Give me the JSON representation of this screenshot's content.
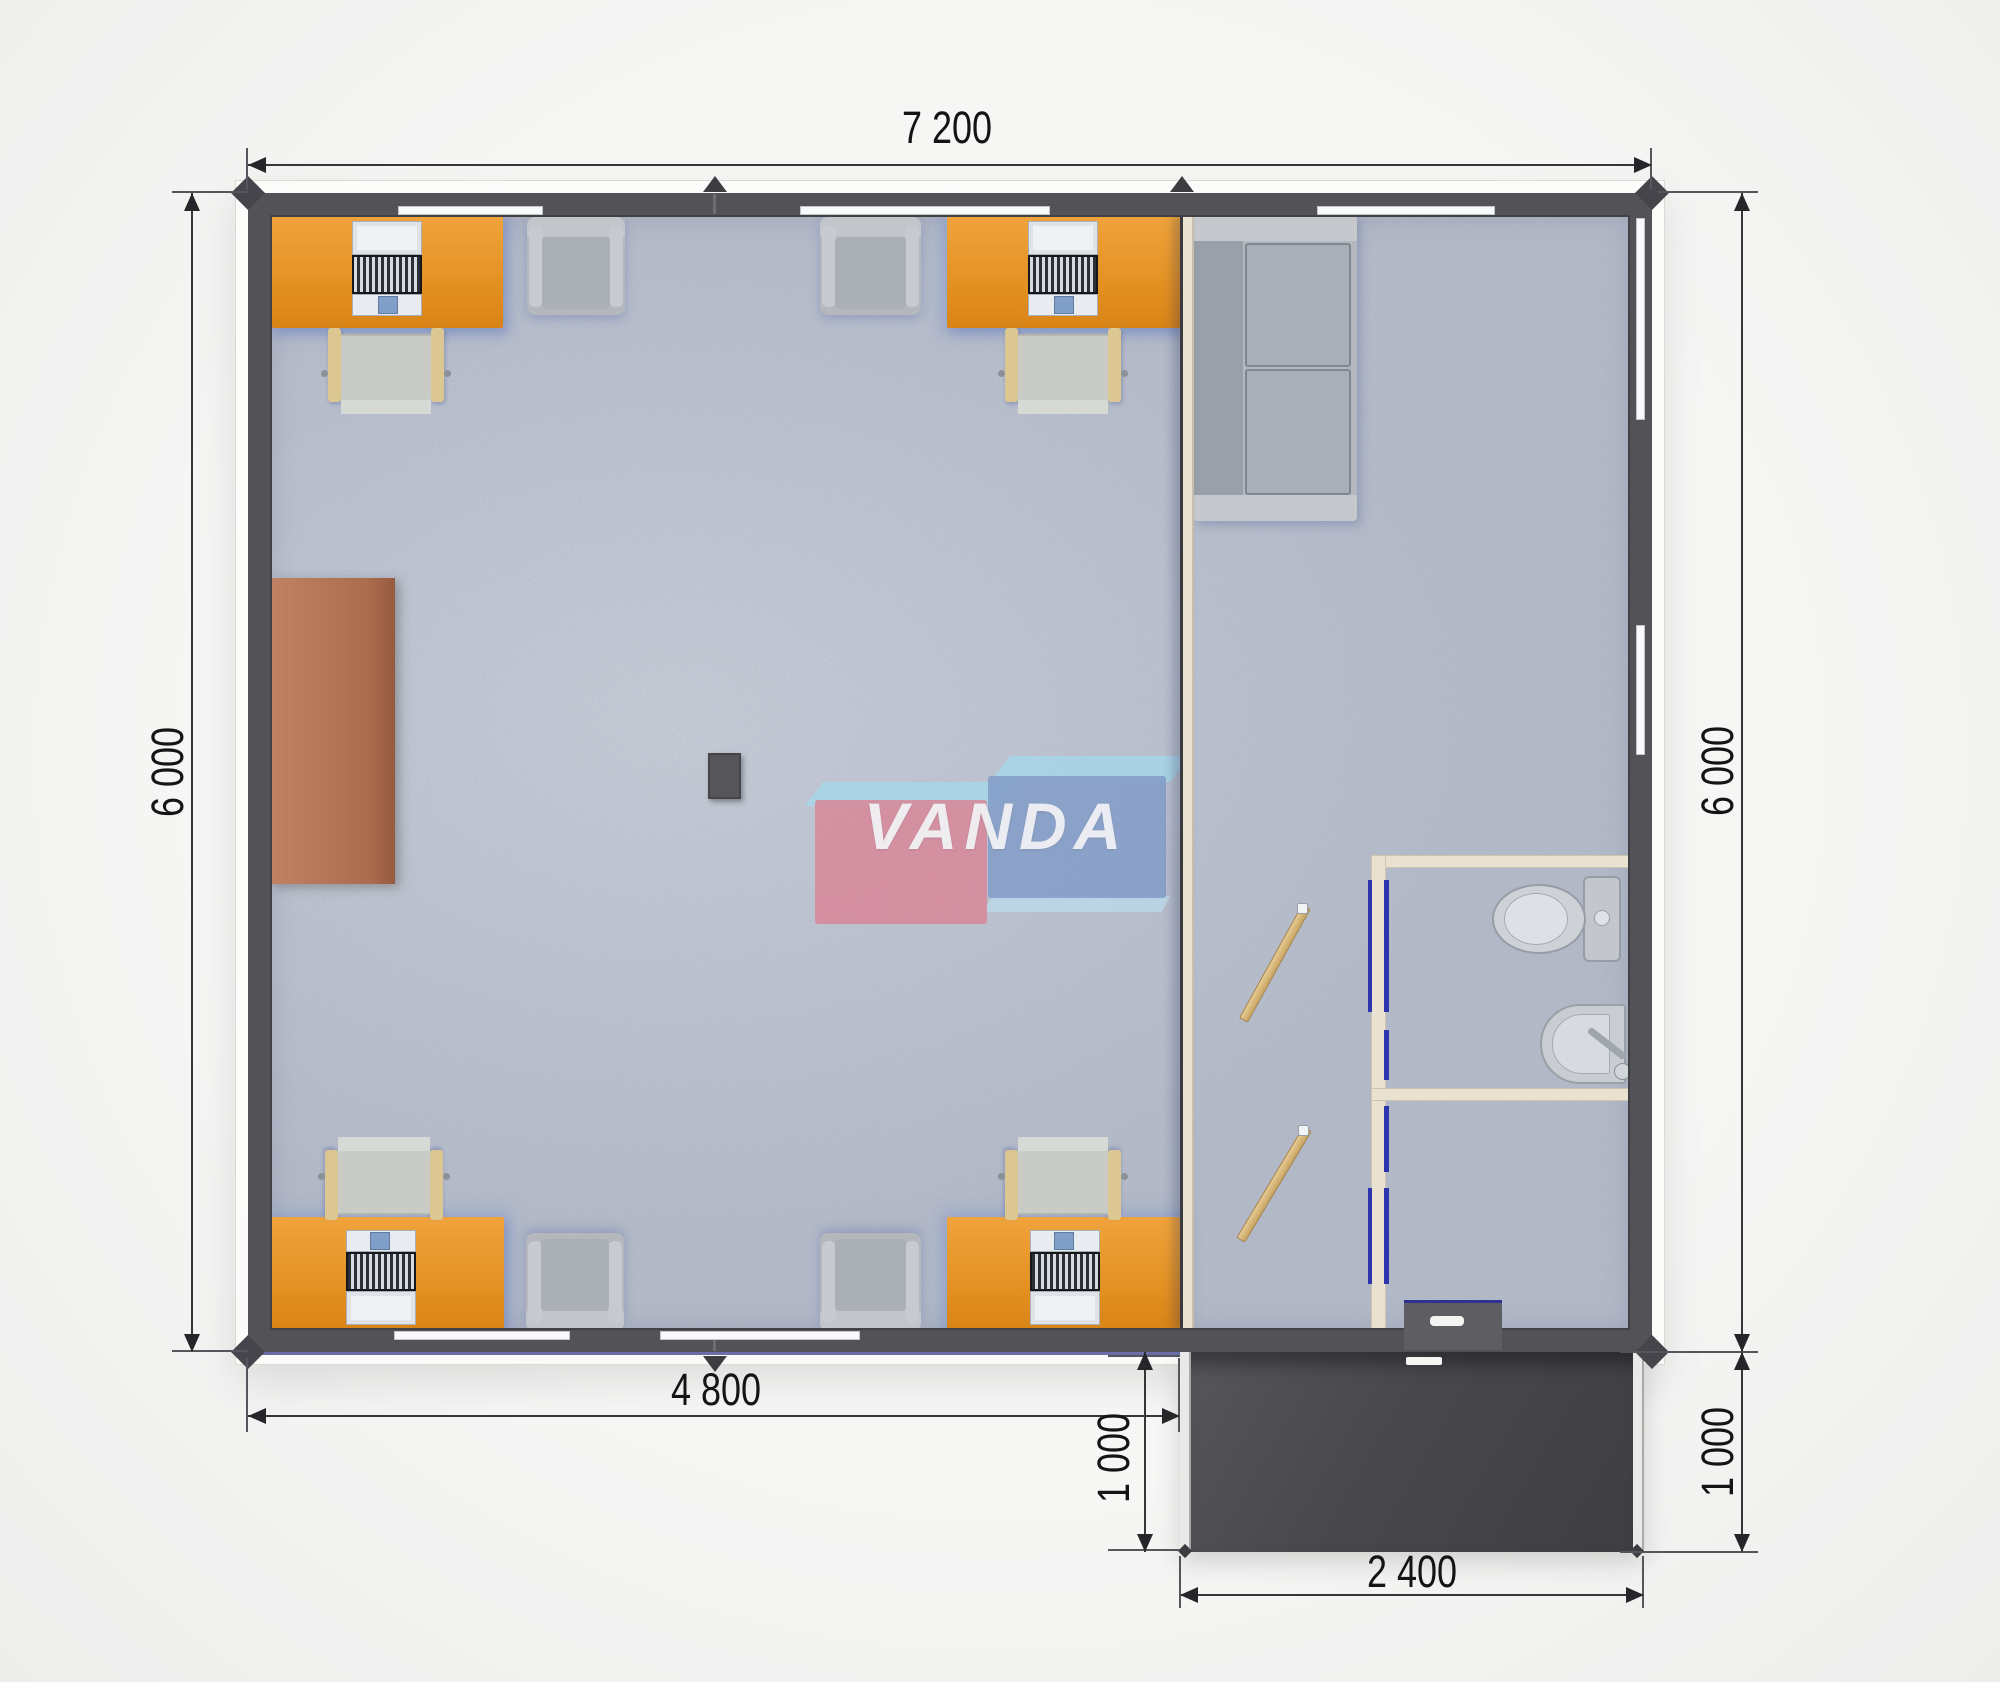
{
  "brand": {
    "name": "VANDA"
  },
  "dimensions": {
    "overall_width": "7 200",
    "left_height": "6 000",
    "right_height": "6 000",
    "office_width": "4 800",
    "porch_depth_left": "1 000",
    "porch_depth_right": "1 000",
    "porch_width": "2 400"
  },
  "furniture_counts": {
    "desks": 4,
    "office_chairs": 4,
    "armchairs": 4,
    "sofa": 1,
    "cabinet": 1,
    "toilet": 1,
    "sink": 1,
    "interior_doors": 2
  },
  "colors": {
    "wall": "#525257",
    "floor_carpet": "#b9bfcc",
    "desk_orange": "#e6941f",
    "chair_wood": "#dcc691",
    "seat_gray": "#c9ccc6",
    "armchair_gray": "#b4b8bd",
    "sofa_gray": "#b2b6bc",
    "cabinet_brown": "#b97a5c",
    "partition_cream": "#eae2d0",
    "door_frame_blue": "#2e33ae",
    "door_wood": "#d8b678",
    "porch_dark": "#48484c",
    "dimension_text": "#141416",
    "logo_pink": "#de7a8c",
    "logo_blue": "#7694c7",
    "logo_sky": "#a6d7ea"
  }
}
